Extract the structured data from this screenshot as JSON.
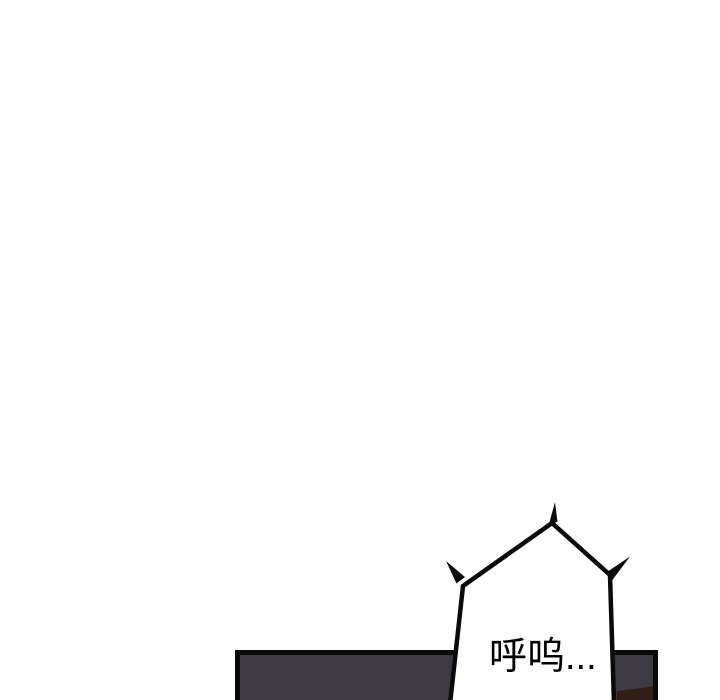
{
  "page": {
    "background_color": "#ffffff"
  },
  "comic": {
    "panel": {
      "fill_color": "#3e3a43",
      "outline_color": "#0a0a0a",
      "floor_brown_color": "#321d19"
    },
    "speech_bubble": {
      "fill_color": "#ffffff",
      "outline_color": "#0a0a0a",
      "text": "呼呜...",
      "text_color": "#000000"
    }
  }
}
